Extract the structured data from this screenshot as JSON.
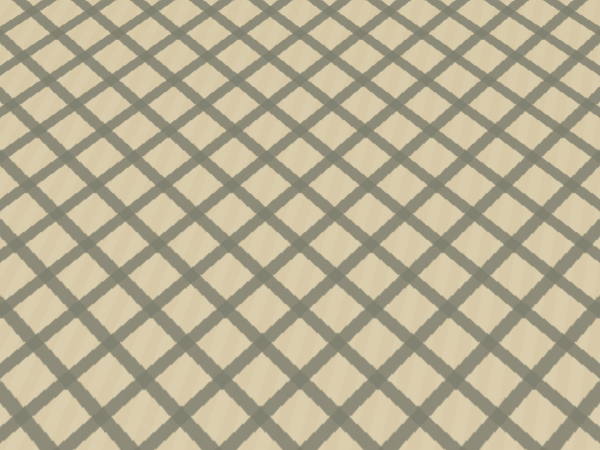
{
  "scene": {
    "description": "Exhibition hall interior: large oval table displaying a green city-planning scale model, lattice-patterned marble floor, wall map, poster stand, red flower vases, draped white table, two partial visitor figures, black marble pedestal, and a white touchscreen kiosk",
    "people_visible": 2,
    "legible_text": ""
  },
  "floor": {
    "tile_color": "#dfd2b2",
    "grout_color": "#80806f",
    "green_reflection_tint": "#60a830"
  },
  "walls": {
    "marble_color": "#cfc2a6",
    "column_color": "#eeebe1",
    "red_panel_color": "#6e251a",
    "map_fill_color": "#d2e2cf",
    "map_frame_color": "#3c3c36",
    "gold_floor_inlay_color": "#b8913c",
    "flower_color": "#c42424",
    "vase_color": "#2a3550",
    "pedestal_color": "#1a140f",
    "draped_table_color": "#f4f2ea"
  },
  "table": {
    "rim_color": "#ece9e0",
    "trim_color": "#b7c142",
    "copper_skirt_color": "#b5793f"
  },
  "model": {
    "terrain_color": "#3f9128",
    "forest_color": "#2c6e1e",
    "river_color": "#2f9fe0",
    "canal_color": "#35a8d8",
    "road_color": "#d6cf92",
    "railway_color": "#50552e",
    "landmark_ring_color": "#caa348",
    "landmark_lake_color": "#4fb0e0",
    "landmark_accent_color": "#4fe8d8",
    "brown_block_color": "#8a4a1e",
    "building_clusters": [
      {
        "name": "nw-residential",
        "x": 150,
        "y": 138,
        "w": 85,
        "h": 42,
        "n": 70,
        "palette": [
          "#eae8da",
          "#d8d4c2",
          "#c9c6b2"
        ]
      },
      {
        "name": "north-dense",
        "x": 238,
        "y": 116,
        "w": 92,
        "h": 30,
        "n": 55,
        "palette": [
          "#e4e0ce",
          "#cfc9b4"
        ]
      },
      {
        "name": "west-mid",
        "x": 138,
        "y": 202,
        "w": 88,
        "h": 58,
        "n": 95,
        "palette": [
          "#efeee2",
          "#d8d4c0",
          "#e8e0c8"
        ]
      },
      {
        "name": "center-dense",
        "x": 232,
        "y": 226,
        "w": 98,
        "h": 72,
        "n": 140,
        "palette": [
          "#f0eee0",
          "#dcd6c0",
          "#cfc8b0"
        ]
      },
      {
        "name": "south-center",
        "x": 332,
        "y": 232,
        "w": 82,
        "h": 56,
        "n": 90,
        "palette": [
          "#eeeade",
          "#d8d2bc"
        ]
      },
      {
        "name": "southeast",
        "x": 418,
        "y": 218,
        "w": 100,
        "h": 62,
        "n": 115,
        "palette": [
          "#f2f0e4",
          "#dedabf",
          "#ffffff"
        ]
      },
      {
        "name": "southwest",
        "x": 92,
        "y": 266,
        "w": 88,
        "h": 40,
        "n": 55,
        "palette": [
          "#eceadf",
          "#d5d0ba"
        ]
      },
      {
        "name": "east-mid",
        "x": 444,
        "y": 148,
        "w": 72,
        "h": 46,
        "n": 55,
        "palette": [
          "#e8e4d2",
          "#d2ccb6"
        ]
      },
      {
        "name": "tan-rows",
        "x": 386,
        "y": 270,
        "w": 42,
        "h": 28,
        "n": 35,
        "palette": [
          "#d8ae88",
          "#c89a70"
        ]
      },
      {
        "name": "trees-north",
        "x": 120,
        "y": 105,
        "w": 360,
        "h": 45,
        "n": 80,
        "size": 1.4,
        "palette": [
          "#2b6a1c",
          "#33781f"
        ]
      },
      {
        "name": "trees-west",
        "x": 70,
        "y": 150,
        "w": 120,
        "h": 120,
        "n": 60,
        "size": 1.4,
        "palette": [
          "#2b6a1c",
          "#347a20"
        ]
      }
    ],
    "lit_clusters": [
      {
        "name": "cbd-lights",
        "x": 352,
        "y": 140,
        "w": 86,
        "h": 64,
        "n": 90,
        "size": 1.3,
        "palette": [
          "#ffffff",
          "#ffd870",
          "#4fd8e8",
          "#ffb050"
        ]
      },
      {
        "name": "gold-block-lights",
        "x": 466,
        "y": 180,
        "w": 78,
        "h": 46,
        "n": 70,
        "size": 1.4,
        "palette": [
          "#ffe080",
          "#fff4c0",
          "#ffc850"
        ]
      },
      {
        "name": "landmark-area-lights",
        "x": 255,
        "y": 148,
        "w": 105,
        "h": 50,
        "n": 45,
        "size": 1.2,
        "palette": [
          "#ffe9a0",
          "#4fe8d8",
          "#ffffff"
        ]
      }
    ],
    "magenta_accents": [
      [
        418,
        147
      ],
      [
        520,
        187
      ],
      [
        340,
        133
      ]
    ]
  },
  "kiosk": {
    "body_color": "#eceae2",
    "bezel_color": "#10100f",
    "screen_color": "#2878c8",
    "screen_thumbnail_palette": [
      "#e8f4f0",
      "#bfe0c8",
      "#d8ecf8",
      "#cfe8d0",
      "#f0f8ff",
      "#a8d0e0"
    ]
  }
}
